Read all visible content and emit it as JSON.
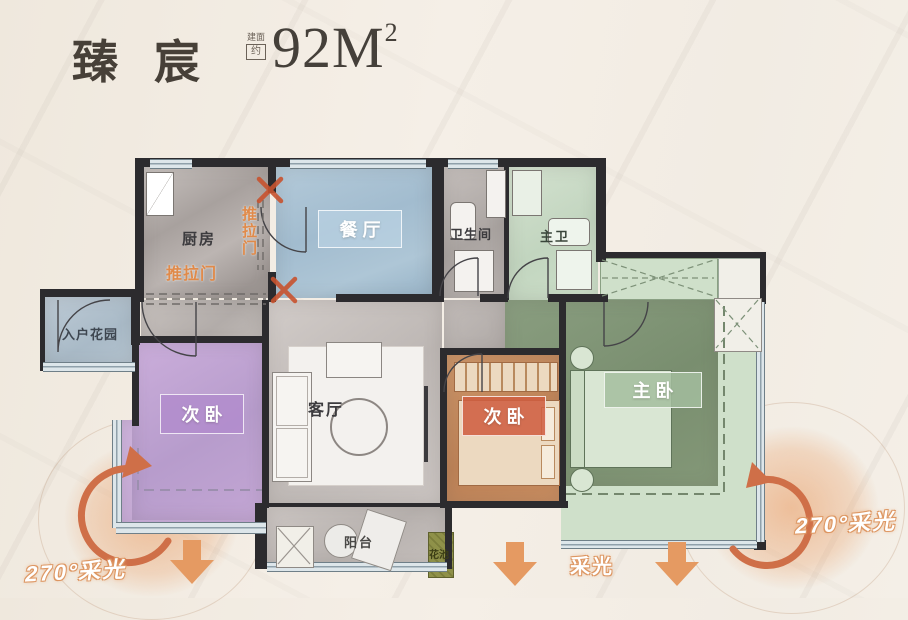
{
  "header": {
    "title": "臻宸",
    "area_note_top": "建面",
    "area_note_bottom": "约",
    "area_value": "92M",
    "area_unit_sup": "2"
  },
  "rooms": {
    "kitchen": "厨房",
    "dining": "餐厅",
    "bathroom": "卫生间",
    "master_bath": "主卫",
    "entry_garden": "入户花园",
    "bedroom_west": "次卧",
    "living": "客厅",
    "bedroom_middle": "次卧",
    "master_bedroom": "主卧",
    "balcony": "阳台",
    "flower_bed": "花池"
  },
  "annotations": {
    "sliding_door_bottom": "推拉门",
    "sliding_door_side": "推拉门",
    "daylight_left": "270°采光",
    "daylight_right": "270°采光",
    "daylight_center": "采光"
  },
  "colors": {
    "accent_orange": "#e59a62",
    "arrow_deep_orange": "#cf6f48",
    "cross_mark": "#c8532f",
    "dining_blue": "#a8c2d4",
    "bedroom_purple": "#c2a5d5",
    "bedroom_terracotta": "#c78c60",
    "master_green": "#849878",
    "light_green": "#cfe0ca",
    "entry_blue": "#b3c3cf",
    "wall_dark": "#2c2b2e",
    "title_ink": "#474038"
  }
}
